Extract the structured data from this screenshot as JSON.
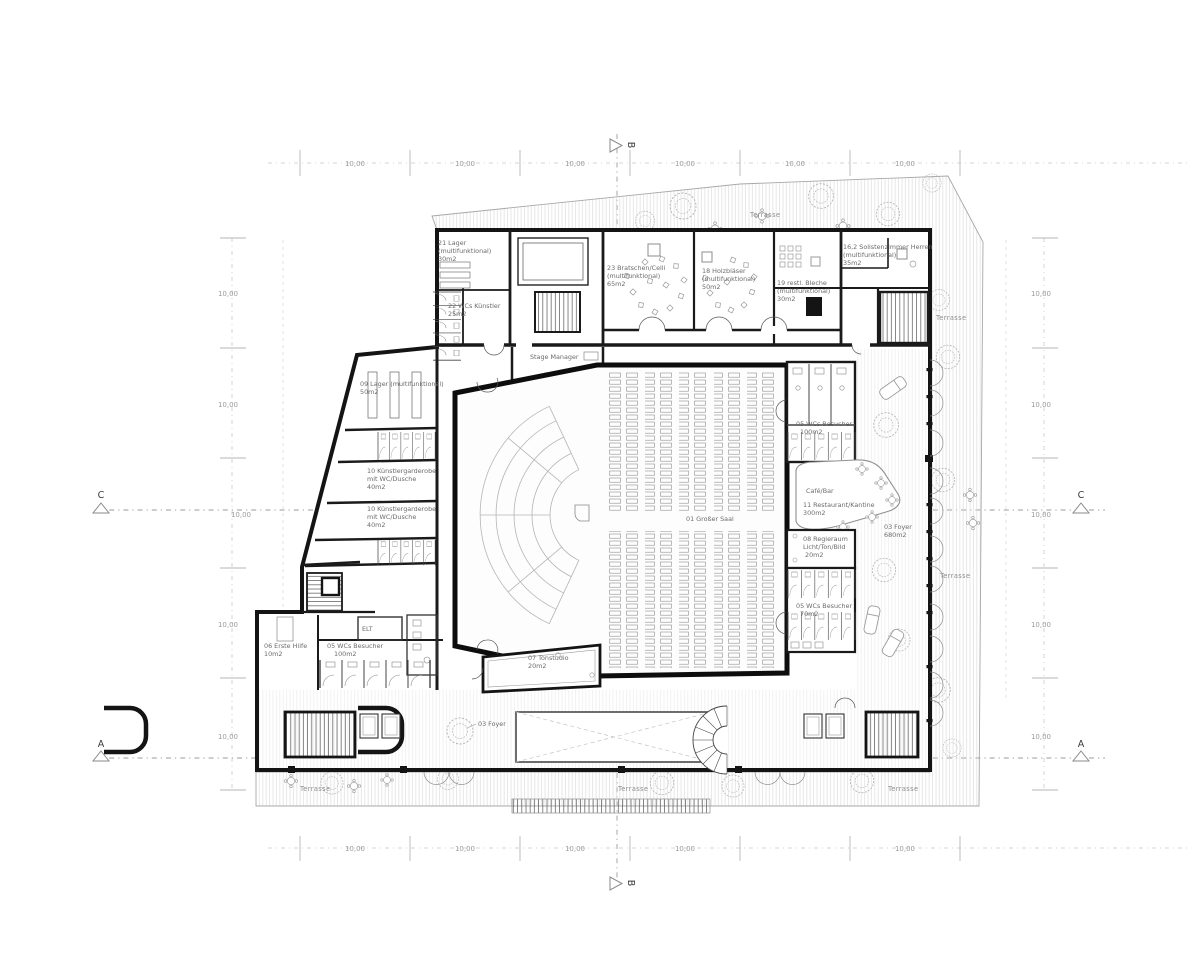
{
  "sections": {
    "a": "A",
    "b": "B",
    "c": "C"
  },
  "grid": {
    "dim": "10,00"
  },
  "terrace_label": "Terrasse",
  "rooms": {
    "lager21": {
      "lines": [
        "21 Lager",
        "(multifunktional)",
        "30m2"
      ]
    },
    "wcs_kuenstler": {
      "lines": [
        "22 WCs Künstler",
        "25m2"
      ]
    },
    "bratschen": {
      "lines": [
        "23 Bratschen/Celli",
        "(multifunktional)",
        "65m2"
      ]
    },
    "holzblaeser": {
      "lines": [
        "18 Holzbläser",
        "(multifunktional)",
        "50m2"
      ]
    },
    "bleche": {
      "lines": [
        "19 restl. Bleche",
        "(multifunktional)",
        "30m2"
      ]
    },
    "solisten": {
      "lines": [
        "16,2 Solistenzimmer Herren",
        "(multifunktional)",
        "35m2"
      ]
    },
    "stage_manager": {
      "lines": [
        "Stage Manager"
      ]
    },
    "lager09": {
      "lines": [
        "09 Lager (multifunktional)",
        "50m2"
      ]
    },
    "garderobe1": {
      "lines": [
        "10 Künstlergarderobe",
        "mit WC/Dusche",
        "40m2"
      ]
    },
    "garderobe2": {
      "lines": [
        "10 Künstlergarderobe",
        "mit WC/Dusche",
        "40m2"
      ]
    },
    "erste_hilfe": {
      "lines": [
        "06 Erste Hilfe",
        "10m2"
      ]
    },
    "wcs_left": {
      "lines": [
        "05 WCs Besucher",
        "100m2"
      ]
    },
    "elt": {
      "lines": [
        "ELT"
      ]
    },
    "tonstudio": {
      "lines": [
        "07 Tonstudio",
        "20m2"
      ]
    },
    "grosser_saal": {
      "lines": [
        "01 Großer Saal"
      ]
    },
    "wcs_right_1": {
      "lines": [
        "05 WCs Besucher",
        "100m2"
      ]
    },
    "cafe_bar": {
      "lines": [
        "Café/Bar"
      ]
    },
    "restaurant": {
      "lines": [
        "11 Restaurant/Kantine",
        "300m2"
      ]
    },
    "foyer_right": {
      "lines": [
        "03 Foyer",
        "680m2"
      ]
    },
    "regieraum": {
      "lines": [
        "08 Regieraum",
        "Licht/Ton/Bild",
        "20m2"
      ]
    },
    "wcs_right_2": {
      "lines": [
        "05 WCs Besucher",
        "70m2"
      ]
    },
    "foyer_bottom": {
      "lines": [
        "03 Foyer"
      ]
    }
  }
}
